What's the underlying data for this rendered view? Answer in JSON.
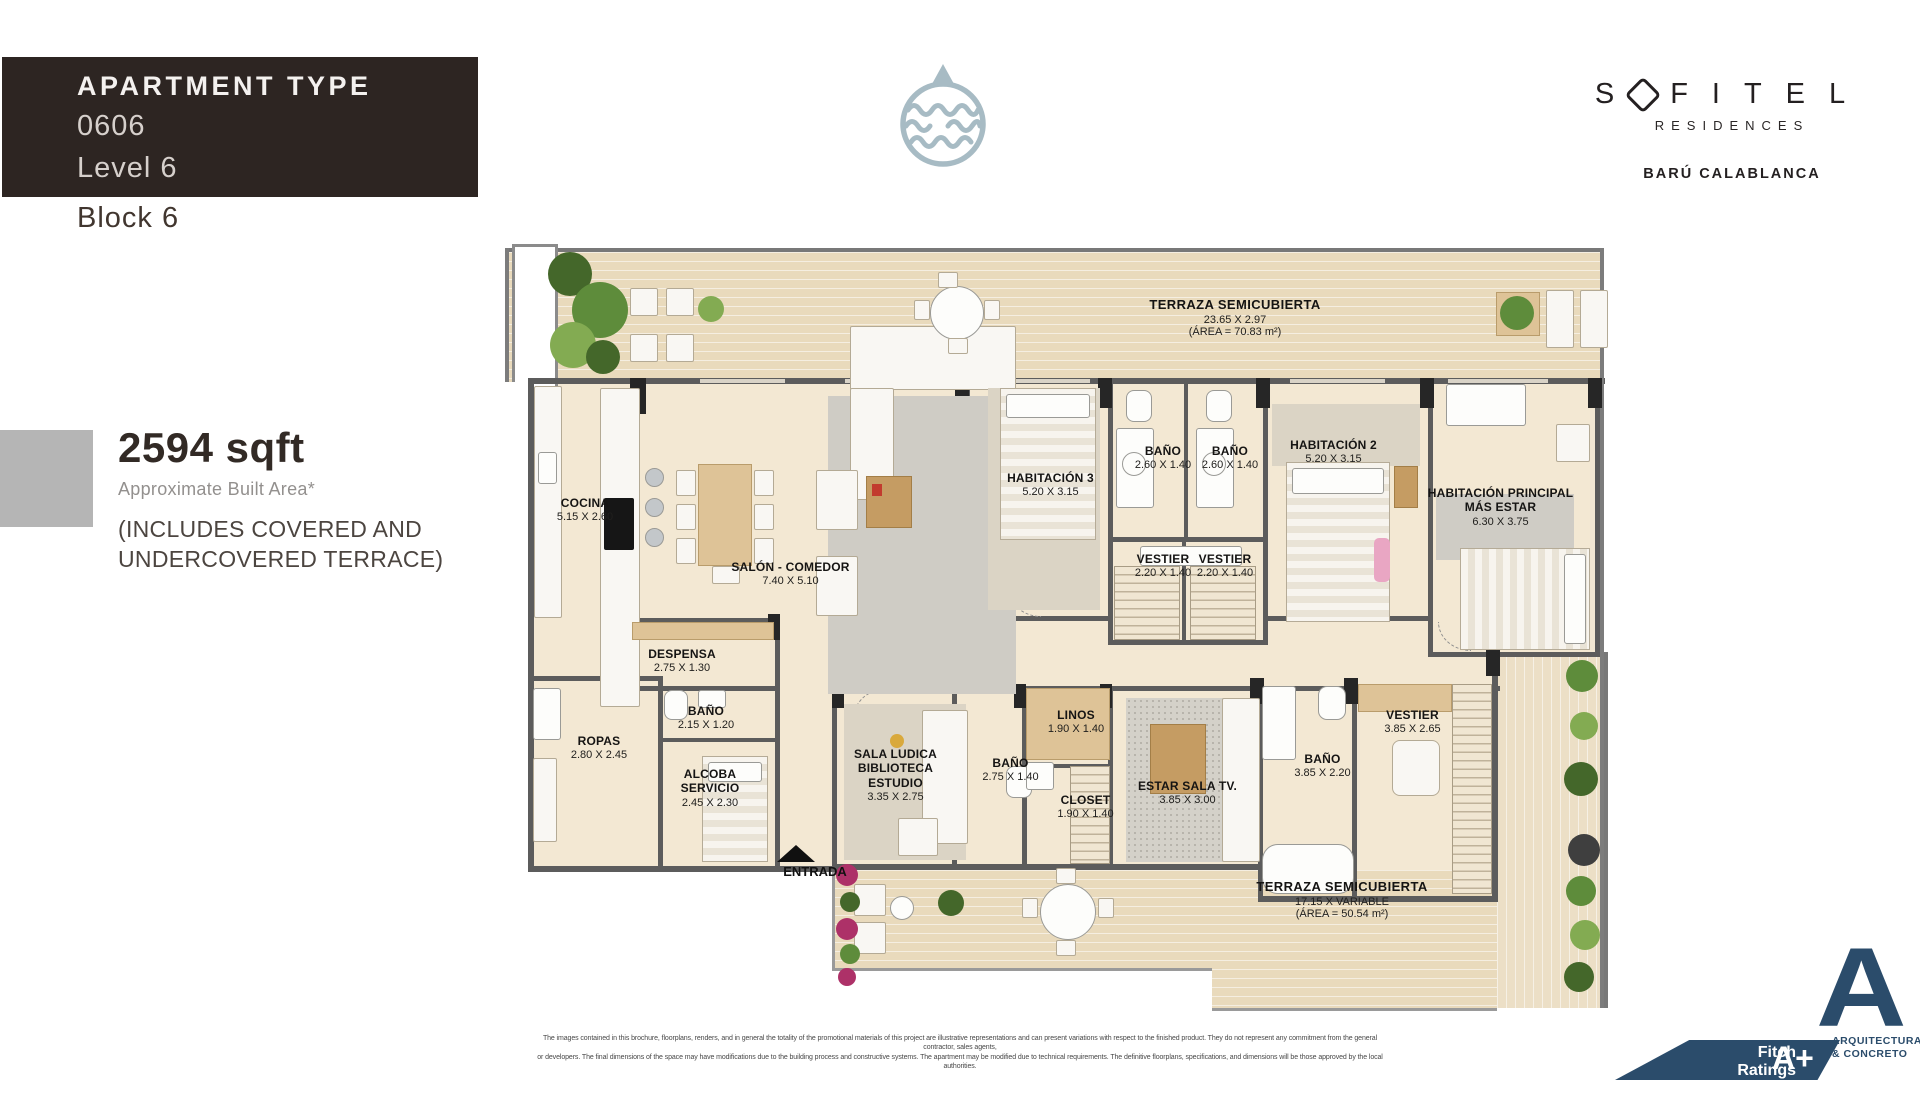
{
  "header": {
    "apartment_type_label": "APARTMENT TYPE",
    "unit": "0606",
    "level": "Level 6",
    "block": "Block 6"
  },
  "brand": {
    "s": "S",
    "rest": "FITEL",
    "residences": "RESIDENCES",
    "location": "BARÚ CALABLANCA"
  },
  "area": {
    "sqft": "2594 sqft",
    "approx": "Approximate Built Area*",
    "includes": "(INCLUDES COVERED AND\nUNDERCOVERED TERRACE)"
  },
  "plan": {
    "entrance_label": "ENTRADA",
    "rooms": [
      {
        "name": "TERRAZA SEMICUBIERTA",
        "dims": "23.65 X 2.97",
        "area": "(ÁREA = 70.83 m²)"
      },
      {
        "name": "COCINA",
        "dims": "5.15 X 2.60"
      },
      {
        "name": "SALÓN - COMEDOR",
        "dims": "7.40 X 5.10"
      },
      {
        "name": "HABITACIÓN 3",
        "dims": "5.20 X 3.15"
      },
      {
        "name": "BAÑO",
        "dims": "2.60 X 1.40"
      },
      {
        "name": "BAÑO",
        "dims": "2.60 X 1.40"
      },
      {
        "name": "HABITACIÓN 2",
        "dims": "5.20 X 3.15"
      },
      {
        "name": "VESTIER",
        "dims": "2.20 X 1.40"
      },
      {
        "name": "VESTIER",
        "dims": "2.20 X 1.40"
      },
      {
        "name": "HABITACIÓN PRINCIPAL\nMÁS ESTAR",
        "dims": "6.30 X 3.75"
      },
      {
        "name": "DESPENSA",
        "dims": "2.75 X 1.30"
      },
      {
        "name": "BAÑO",
        "dims": "2.15 X 1.20"
      },
      {
        "name": "ROPAS",
        "dims": "2.80 X 2.45"
      },
      {
        "name": "ALCOBA\nSERVICIO",
        "dims": "2.45 X 2.30"
      },
      {
        "name": "SALA LUDICA\nBIBLIOTECA\nESTUDIO",
        "dims": "3.35 X 2.75"
      },
      {
        "name": "BAÑO",
        "dims": "2.75 X 1.40"
      },
      {
        "name": "LINOS",
        "dims": "1.90 X 1.40"
      },
      {
        "name": "CLOSET",
        "dims": "1.90 X 1.40"
      },
      {
        "name": "ESTAR SALA TV.",
        "dims": "3.85 X 3.00"
      },
      {
        "name": "BAÑO",
        "dims": "3.85 X 2.20"
      },
      {
        "name": "VESTIER",
        "dims": "3.85 X 2.65"
      },
      {
        "name": "TERRAZA SEMICUBIERTA",
        "dims": "17.15 X VARIABLE",
        "area": "(ÁREA = 50.54 m²)"
      }
    ]
  },
  "footer": {
    "line1": "The images contained in this brochure, floorplans, renders, and in general the totality of the promotional materials of this project are illustrative representations and can present variations with respect to the finished product. They do not represent any commitment from the general contractor, sales agents,",
    "line2": "or developers. The final dimensions of the space may have modifications due to the building process and constructive systems. The apartment may be modified due to technical requirements. The definitive floorplans, specifications, and dimensions will be those approved by the local authorities."
  },
  "badges": {
    "fitch_line1": "Fitch Ratings",
    "fitch_line2": "Score",
    "fitch_grade": "A+",
    "arch_a": "A",
    "arch_line1": "ARQUITECTURA",
    "arch_line2": "& CONCRETO"
  },
  "icons": {
    "brand_mark": "water-waves-in-circle",
    "sofitel_o": "diamond-o",
    "entrance": "up-triangle-arrow"
  },
  "colors": {
    "header_bg": "#2d2522",
    "brand_blue": "#2b4c6b",
    "logo_blue_gray": "#a7bbc4",
    "accent_gray": "#b5b5b5",
    "floor_beige": "#f3e8d3",
    "terrace_tan": "#e9dabc",
    "wall_gray": "#5c5c5c"
  }
}
